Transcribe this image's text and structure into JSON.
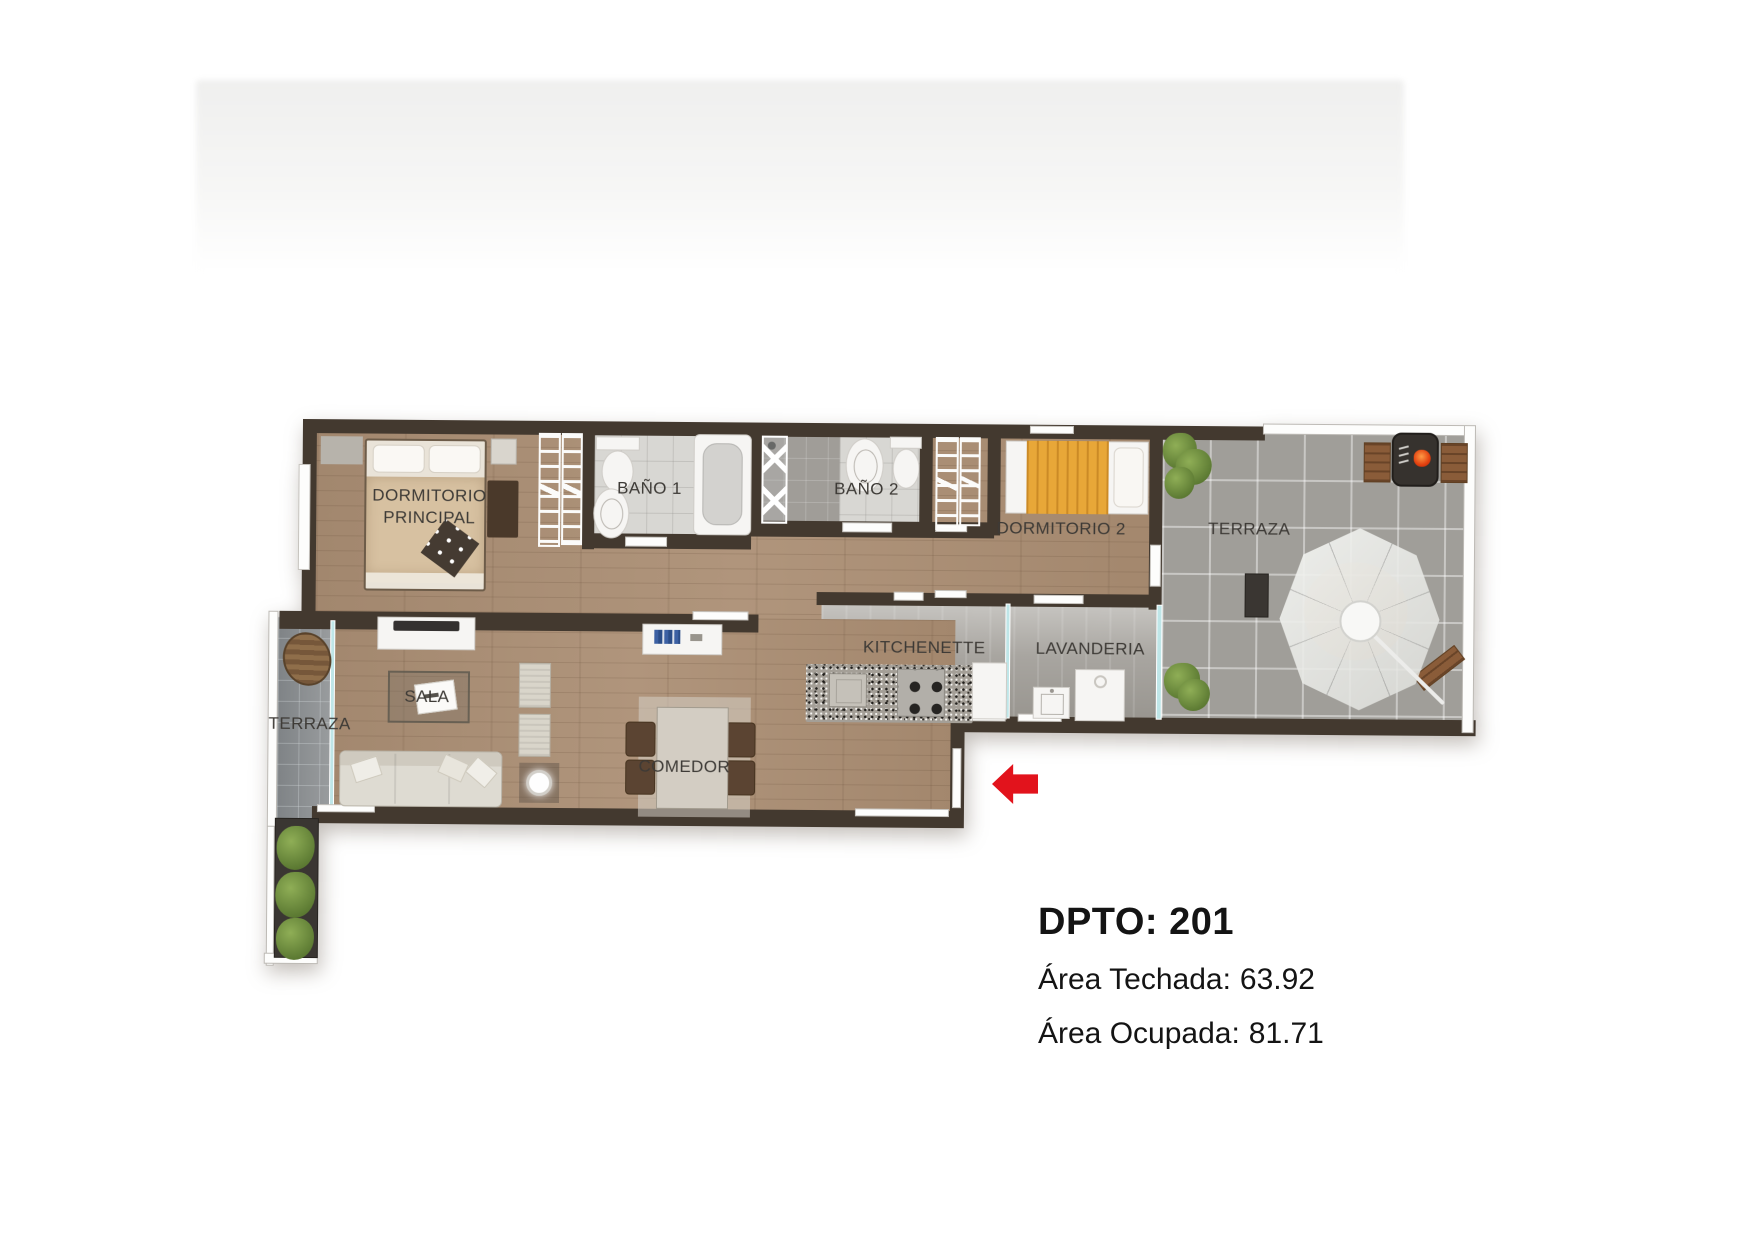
{
  "info": {
    "title": "DPTO: 201",
    "lines": [
      {
        "label": "Área Techada:",
        "value": "63.92"
      },
      {
        "label": "Área Ocupada:",
        "value": "81.71"
      }
    ]
  },
  "plan": {
    "labels": [
      {
        "id": "dormitorio-principal",
        "text": "DORMITORIO PRINCIPAL"
      },
      {
        "id": "bano-1",
        "text": "BAÑO 1"
      },
      {
        "id": "bano-2",
        "text": "BAÑO 2"
      },
      {
        "id": "dormitorio-2",
        "text": "DORMITORIO 2"
      },
      {
        "id": "terraza-right",
        "text": "TERRAZA"
      },
      {
        "id": "kitchenette",
        "text": "KITCHENETTE"
      },
      {
        "id": "lavanderia",
        "text": "LAVANDERIA"
      },
      {
        "id": "sala",
        "text": "SALA"
      },
      {
        "id": "terraza-left",
        "text": "TERRAZA"
      },
      {
        "id": "comedor",
        "text": "COMEDOR"
      }
    ],
    "icons": {
      "entrance_arrow": "left-arrow",
      "bbq_grill": "grill-with-flame",
      "umbrella": "patio-umbrella"
    },
    "colors": {
      "wall": "#43392f",
      "wood_floor": "#a98e76",
      "terrace_tile": "#a09e99",
      "bath_tile": "#d8d7d3",
      "kitchen_floor": "#a8a5a0",
      "glass_partition": "#bfe6e8",
      "accent_arrow": "#e2131c",
      "bed_main_blanket": "#d7c1a1",
      "bed2_blanket": "#e8a738",
      "plants": "#5e7c34",
      "text": "#141414"
    }
  }
}
